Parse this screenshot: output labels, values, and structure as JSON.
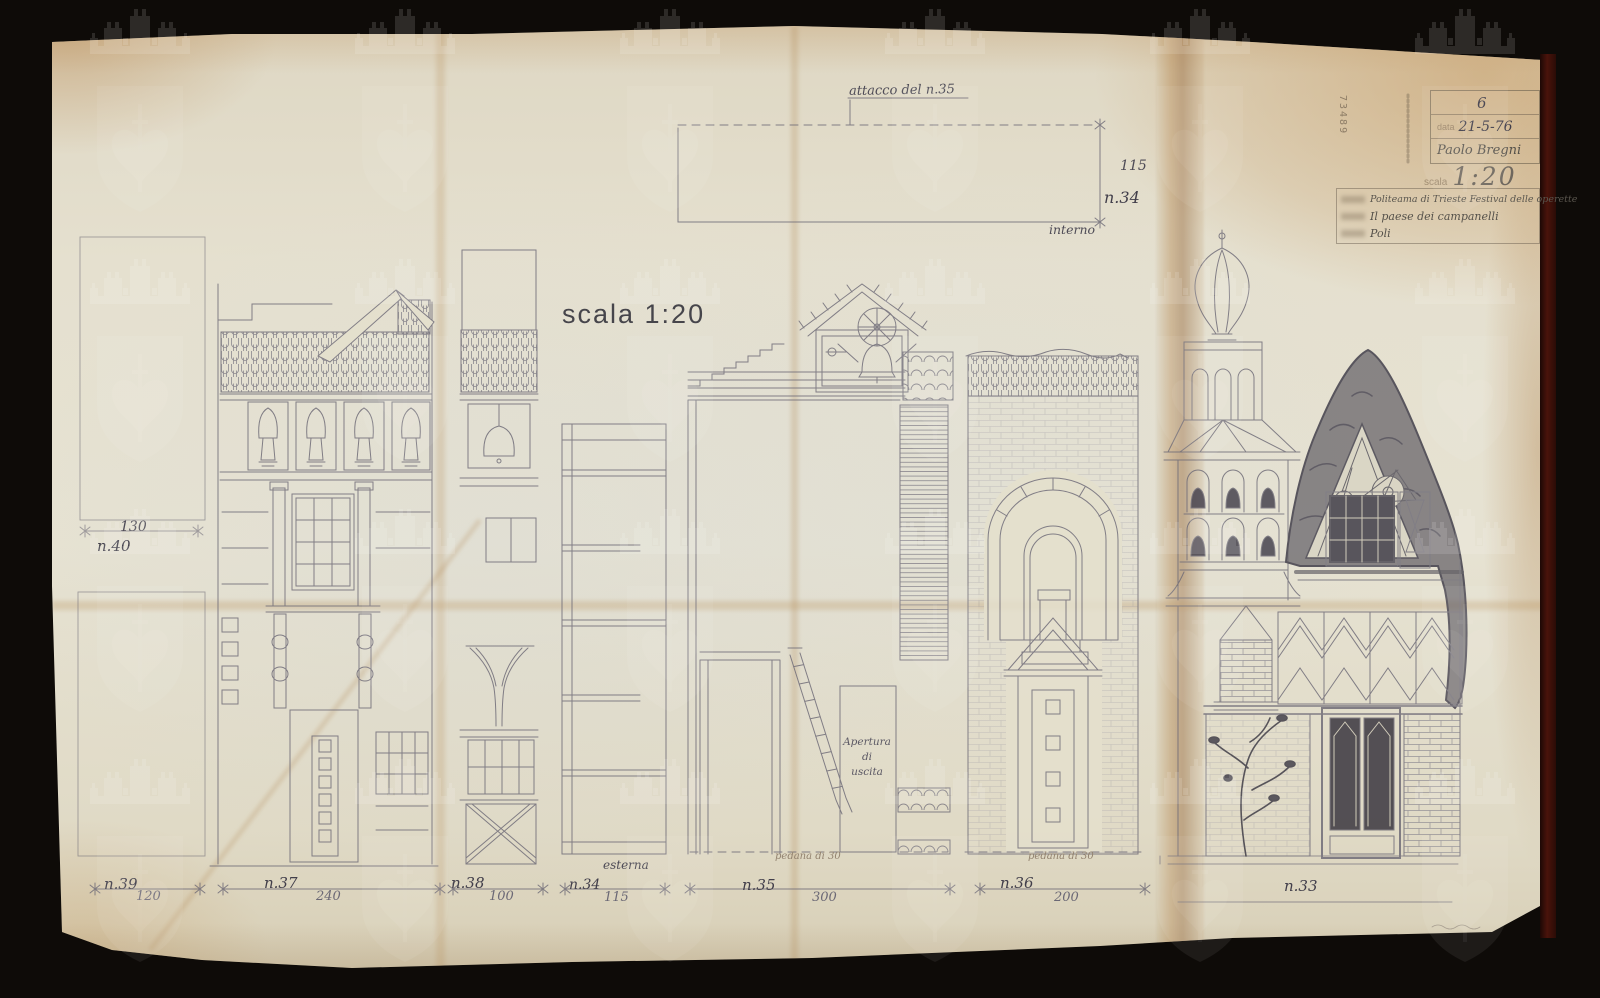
{
  "artifact": {
    "scale_note": "scala 1:20",
    "stamp_number": "73489"
  },
  "title_block": {
    "sheet_number": "6",
    "date_label": "data",
    "date_value": "21-5-76",
    "designer": "Paolo Bregni",
    "scale_label": "scala",
    "scale_value": "1:20",
    "venue_line": "Politeama di Trieste  Festival delle operette",
    "title_line": "Il paese dei campanelli",
    "author_line": "Poli"
  },
  "top_detail": {
    "attach_label": "attacco del n.35",
    "height_dim": "115",
    "piece_label": "n.34",
    "side_label": "interno"
  },
  "left_pieces": {
    "n40_label": "n.40",
    "n40_dim": "130",
    "n39_label": "n.39",
    "n39_dim": "120"
  },
  "pieces": {
    "n37": {
      "label": "n.37",
      "dim": "240"
    },
    "n38": {
      "label": "n.38",
      "dim": "100"
    },
    "n34": {
      "label": "n.34",
      "dim": "115",
      "side_note": "esterna"
    },
    "n35": {
      "label": "n.35",
      "dim": "300",
      "floor_note": "pedana di 30",
      "exit_note_1": "Apertura",
      "exit_note_2": "di",
      "exit_note_3": "uscita"
    },
    "n36": {
      "label": "n.36",
      "dim": "200",
      "floor_note": "pedana di 30"
    },
    "n33": {
      "label": "n.33"
    }
  }
}
